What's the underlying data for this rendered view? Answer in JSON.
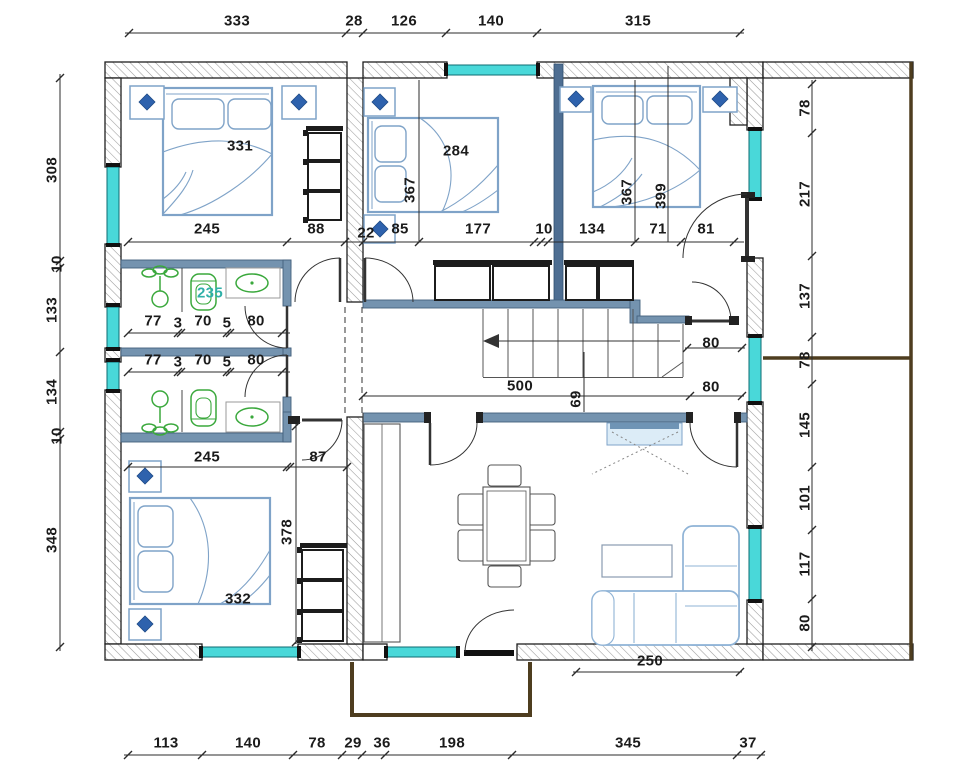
{
  "drawing": {
    "type": "architectural floor plan, upper storey",
    "unit": "cm"
  },
  "colors": {
    "wall_hatch_line": "#a0a0a0",
    "wall_outline": "#1f1f1f",
    "interior_wall_blue": "#7493af",
    "interior_wall_dark": "#4e6e92",
    "window_cyan": "#49d8d9",
    "furniture_blue": "#7fa3c8",
    "fixture_green": "#3aa83c",
    "terrace_brown": "#4e3d1f",
    "bath_label_teal": "#2fb0a8",
    "dim_text": "#1b1b1b"
  },
  "rooms": {
    "bedroom_top_left": "331",
    "bedroom_top_middle": "284",
    "bedroom_bottom_left": "332",
    "bathroom": "235"
  },
  "dims": {
    "top": [
      "333",
      "28",
      "126",
      "140",
      "315"
    ],
    "bottom": [
      "113",
      "140",
      "78",
      "29",
      "36",
      "198",
      "345",
      "37"
    ],
    "left": [
      "308",
      "10",
      "133",
      "134",
      "10",
      "348"
    ],
    "right": [
      "78",
      "217",
      "137",
      "78",
      "145",
      "101",
      "117",
      "80"
    ],
    "mid": [
      "245",
      "88",
      "22",
      "85",
      "177",
      "10",
      "134",
      "71",
      "81"
    ],
    "depths": [
      "367",
      "367",
      "399"
    ],
    "bath_upper": [
      "77",
      "3",
      "70",
      "5",
      "80"
    ],
    "bath_lower": [
      "77",
      "3",
      "70",
      "5",
      "80"
    ],
    "lower": [
      "245",
      "87",
      "378"
    ],
    "stairs": [
      "500",
      "69",
      "80",
      "80"
    ],
    "terrace": [
      "250"
    ]
  }
}
